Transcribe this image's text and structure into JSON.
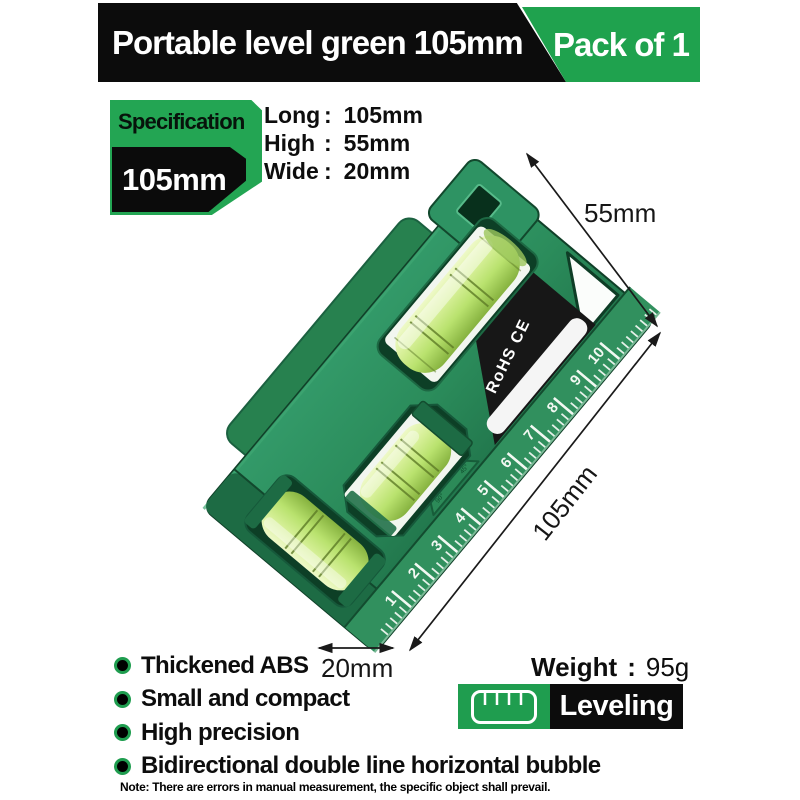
{
  "banner": {
    "title": "Portable level green 105mm",
    "pack_label": "Pack of 1"
  },
  "spec_tag": {
    "label": "Specification",
    "size": "105mm"
  },
  "colon": ":",
  "specs": [
    {
      "label": "Long",
      "value": "105mm"
    },
    {
      "label": "High",
      "value": "55mm"
    },
    {
      "label": "Wide",
      "value": "20mm"
    }
  ],
  "dimensions": {
    "height": "55mm",
    "length": "105mm",
    "width": "20mm"
  },
  "product": {
    "certification": "RoHS CE",
    "ruler_numbers": [
      "1",
      "2",
      "3",
      "4",
      "5",
      "6",
      "7",
      "8",
      "9",
      "10"
    ],
    "angle_marks": [
      "180°",
      "90°",
      "45°"
    ]
  },
  "features": [
    "Thickened ABS",
    "Small and compact",
    "High precision",
    "Bidirectional double line horizontal bubble"
  ],
  "weight": {
    "label": "Weight",
    "value": "95g"
  },
  "badge": {
    "label": "Leveling"
  },
  "note": "Note: There are errors in manual measurement, the specific object shall prevail.",
  "colors": {
    "brand_green": "#1fa24e",
    "body_green": "#2b8d5b",
    "black": "#0c0c0c"
  }
}
